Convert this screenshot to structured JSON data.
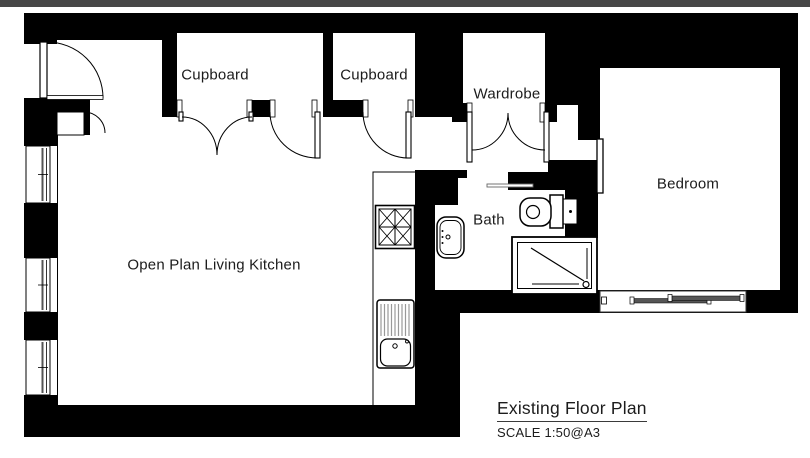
{
  "rooms": [
    {
      "label": "Cupboard"
    },
    {
      "label": "Cupboard"
    },
    {
      "label": "Wardrobe"
    },
    {
      "label": "Bedroom"
    },
    {
      "label": "Bath"
    },
    {
      "label": "Open Plan Living Kitchen"
    }
  ],
  "titleblock": {
    "title": "Existing Floor Plan",
    "scale": "SCALE 1:50@A3"
  },
  "fixtures": [
    {
      "name": "entry-door-swing"
    },
    {
      "name": "meter-cupboard-door"
    },
    {
      "name": "window"
    },
    {
      "name": "window"
    },
    {
      "name": "window"
    },
    {
      "name": "cooker-hob"
    },
    {
      "name": "sink-with-drainer"
    },
    {
      "name": "wash-basin"
    },
    {
      "name": "toilet"
    },
    {
      "name": "shower-tray"
    },
    {
      "name": "double-door-swing"
    },
    {
      "name": "single-door-swing"
    },
    {
      "name": "bedroom-door-leaf"
    },
    {
      "name": "sliding-window"
    }
  ],
  "colors": {
    "wall": "#000000",
    "paper": "#ffffff",
    "top_edge": "#474747",
    "text": "#1c1c1c"
  }
}
